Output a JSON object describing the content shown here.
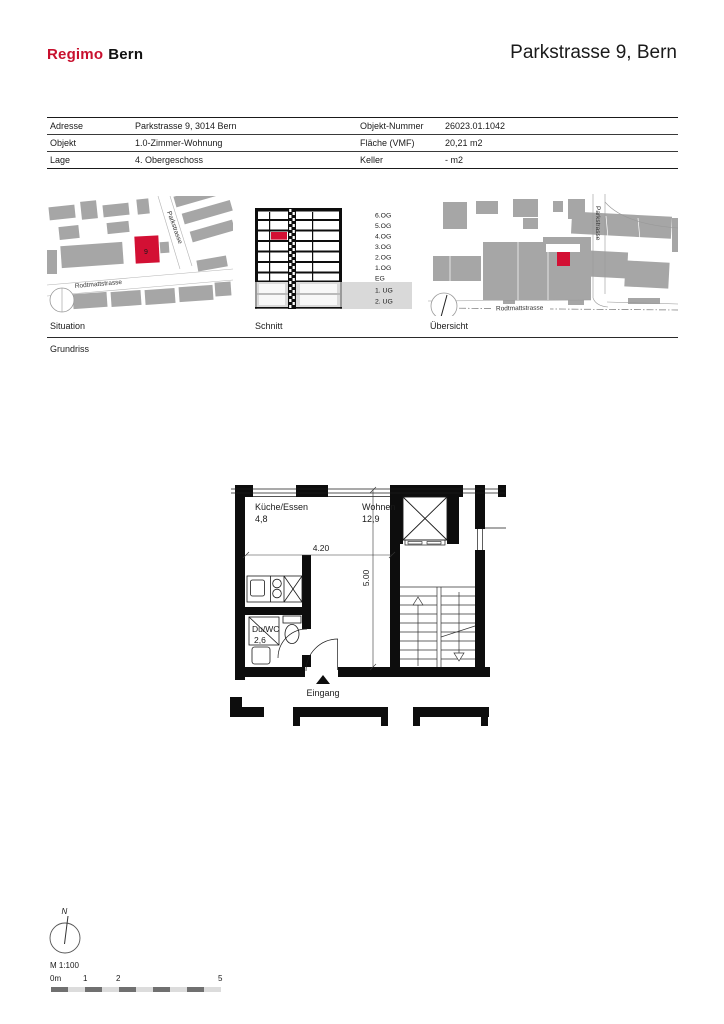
{
  "header": {
    "logo_primary": "Regimo",
    "logo_secondary": "Bern",
    "title": "Parkstrasse 9, Bern"
  },
  "info_table": {
    "rows": [
      {
        "label_left": "Adresse",
        "value_left": "Parkstrasse 9, 3014 Bern",
        "label_right": "Objekt-Nummer",
        "value_right": "26023.01.1042"
      },
      {
        "label_left": "Objekt",
        "value_left": "1.0-Zimmer-Wohnung",
        "label_right": "Fläche (VMF)",
        "value_right": "20,21 m2"
      },
      {
        "label_left": "Lage",
        "value_left": "4. Obergeschoss",
        "label_right": "Keller",
        "value_right": "- m2"
      }
    ]
  },
  "panels": {
    "situation": {
      "caption": "Situation",
      "street_vertical": "Parkstrasse",
      "street_horizontal": "Rodtmattstrasse",
      "building_number": "9"
    },
    "schnitt": {
      "caption": "Schnitt",
      "floor_labels": [
        "6.OG",
        "5.OG",
        "4.OG",
        "3.OG",
        "2.OG",
        "1.OG",
        "EG",
        "1. UG",
        "2. UG"
      ]
    },
    "uebersicht": {
      "caption": "Übersicht",
      "street_vertical": "Parkstrasse",
      "street_horizontal": "Rodtmattstrasse"
    }
  },
  "floorplan": {
    "caption": "Grundriss",
    "rooms": [
      {
        "name": "Küche/Essen",
        "area": "4,8"
      },
      {
        "name": "Wohnen",
        "area": "12,9"
      },
      {
        "name": "Du/WC",
        "area": "2,6"
      }
    ],
    "dimensions": {
      "width": "4.20",
      "height": "5.00"
    },
    "entrance_label": "Eingang"
  },
  "footer": {
    "north_label": "N",
    "scale_label": "M 1:100",
    "scale_ticks": [
      "0m",
      "1",
      "2",
      "5"
    ]
  },
  "colors": {
    "logo_red": "#c8102e",
    "accent_red": "#d31034",
    "building_gray": "#a6a6a6",
    "basement_gray": "#d9d9d9",
    "scalebar_dark": "#707070",
    "scalebar_light": "#dcdcdc",
    "text": "#1a1a1a"
  }
}
